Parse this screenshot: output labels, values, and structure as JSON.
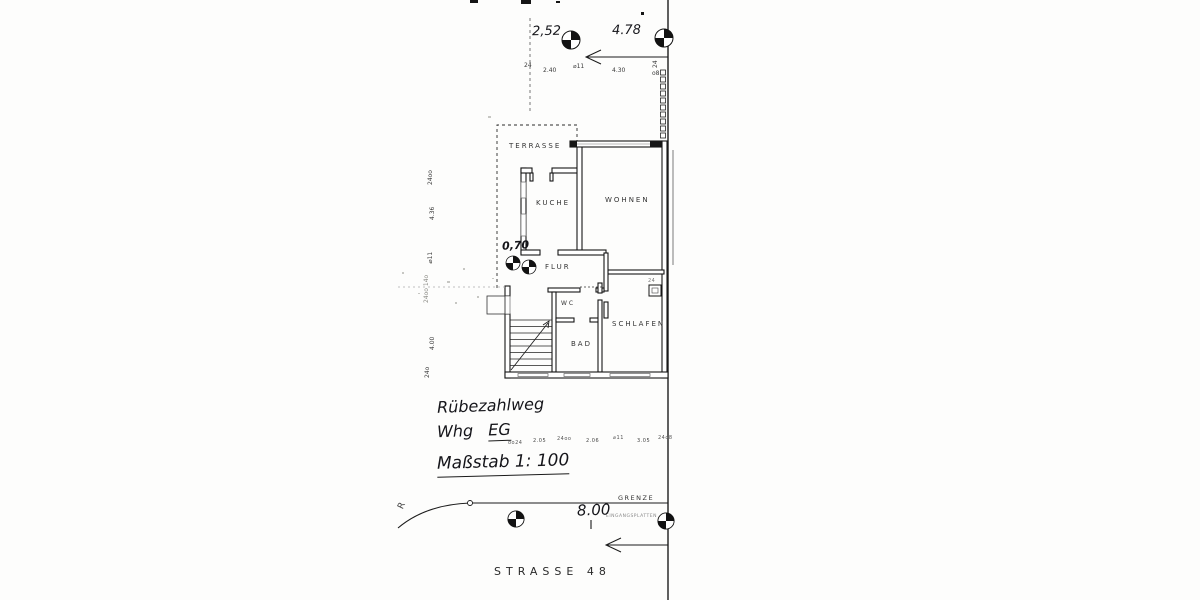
{
  "scan": {
    "street_label": "STRASSE 48",
    "grenze_label": "GRENZE",
    "grenze_sub_label": "EINGANGSPLATTEN",
    "grenze_dim": "8.00",
    "curve_label": "R",
    "dim_070": "0,70",
    "chimney_mark": "24",
    "handwriting": {
      "line1": "Rübezahlweg",
      "line2_prefix": "Whg",
      "line2_unit": "EG",
      "line3": "Maßstab 1: 100"
    },
    "rooms": {
      "terrasse": "TERRASSE",
      "kueche": "KUCHE",
      "wohnen": "WOHNEN",
      "flur": "FLUR",
      "wc": "WC",
      "bad": "BAD",
      "schlafen": "SCHLAFEN"
    },
    "dims_top_main": [
      "2,52",
      "4.78"
    ],
    "dims_top_sub": [
      "24",
      "2.40",
      "⌀11",
      "4.30",
      "24",
      "o8"
    ],
    "dims_left": [
      "24oo",
      "4.36",
      "⌀11",
      "24oo 14o",
      "4.00",
      "24o"
    ],
    "dims_mid": [
      "oo24",
      "2.05",
      "24oo",
      "2.06",
      "⌀11",
      "3.05",
      "24o8"
    ]
  }
}
